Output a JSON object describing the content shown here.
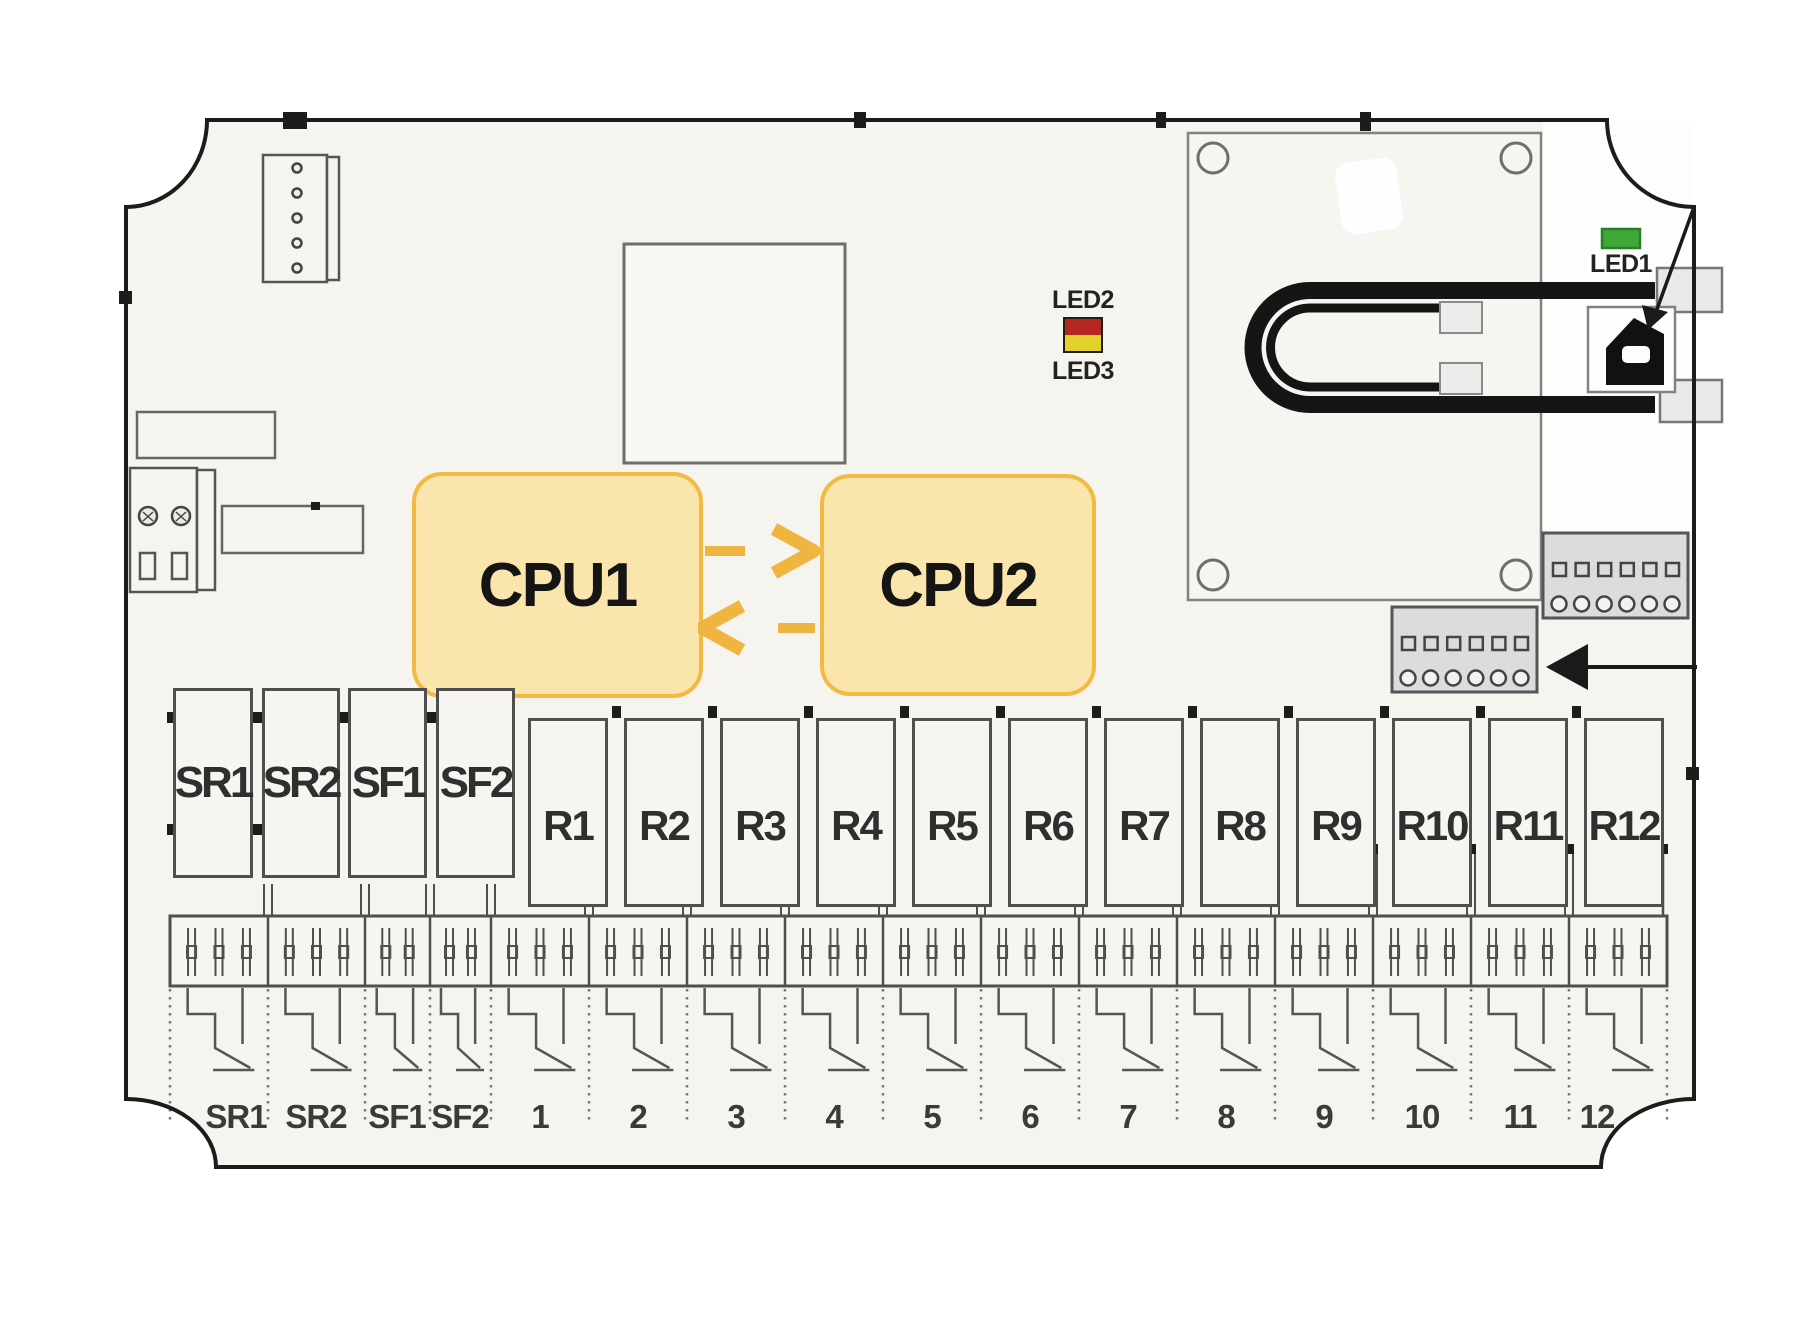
{
  "diagram_title": "relay-board-diagram",
  "colors": {
    "board_fill": "#F5F4EF",
    "board_outline": "#1C1C1C",
    "component_border": "#4F4F4F",
    "light_border": "#6E6E6E",
    "module_border": "#828282",
    "cpu_fill": "#FAE5AD",
    "cpu_border": "#F2BA45",
    "arrow_gold": "#F0B441",
    "led1_green": "#3EA837",
    "led2_red": "#B5271F",
    "led3_yellow": "#E3D02B",
    "gray_block_fill": "#DCDCDC",
    "cable_black": "#151515"
  },
  "cpu": {
    "cpu1_label": "CPU1",
    "cpu2_label": "CPU2"
  },
  "leds": {
    "led1_label": "LED1",
    "led2_label": "LED2",
    "led3_label": "LED3"
  },
  "relay_blocks": {
    "top": [
      {
        "label": "SR1",
        "x": 173,
        "w": 80
      },
      {
        "label": "SR2",
        "x": 262,
        "w": 78
      },
      {
        "label": "SF1",
        "x": 348,
        "w": 79
      },
      {
        "label": "SF2",
        "x": 436,
        "w": 79
      }
    ],
    "top_y": 688,
    "top_h": 190,
    "r_labels": [
      "R1",
      "R2",
      "R3",
      "R4",
      "R5",
      "R6",
      "R7",
      "R8",
      "R9",
      "R10",
      "R11",
      "R12"
    ],
    "r_x0": 528,
    "r_pitch": 96,
    "r_w": 80,
    "r_y": 718,
    "r_h": 189
  },
  "terminal": {
    "boundaries": [
      170,
      268,
      365,
      430,
      491,
      589,
      687,
      785,
      883,
      981,
      1079,
      1177,
      1275,
      1373,
      1471,
      1569,
      1667
    ],
    "pins_per_section": [
      3,
      3,
      2,
      2,
      3,
      3,
      3,
      3,
      3,
      3,
      3,
      3,
      3,
      3,
      3,
      3
    ],
    "strip_y": 916,
    "strip_h": 70
  },
  "bottom_labels": [
    {
      "text": "SR1",
      "cx": 236
    },
    {
      "text": "SR2",
      "cx": 316
    },
    {
      "text": "SF1",
      "cx": 397
    },
    {
      "text": "SF2",
      "cx": 460
    },
    {
      "text": "1",
      "cx": 540
    },
    {
      "text": "2",
      "cx": 638
    },
    {
      "text": "3",
      "cx": 736
    },
    {
      "text": "4",
      "cx": 834
    },
    {
      "text": "5",
      "cx": 932
    },
    {
      "text": "6",
      "cx": 1030
    },
    {
      "text": "7",
      "cx": 1128
    },
    {
      "text": "8",
      "cx": 1226
    },
    {
      "text": "9",
      "cx": 1324
    },
    {
      "text": "10",
      "cx": 1422
    },
    {
      "text": "11",
      "cx": 1520
    },
    {
      "text": "12",
      "cx": 1597
    }
  ]
}
